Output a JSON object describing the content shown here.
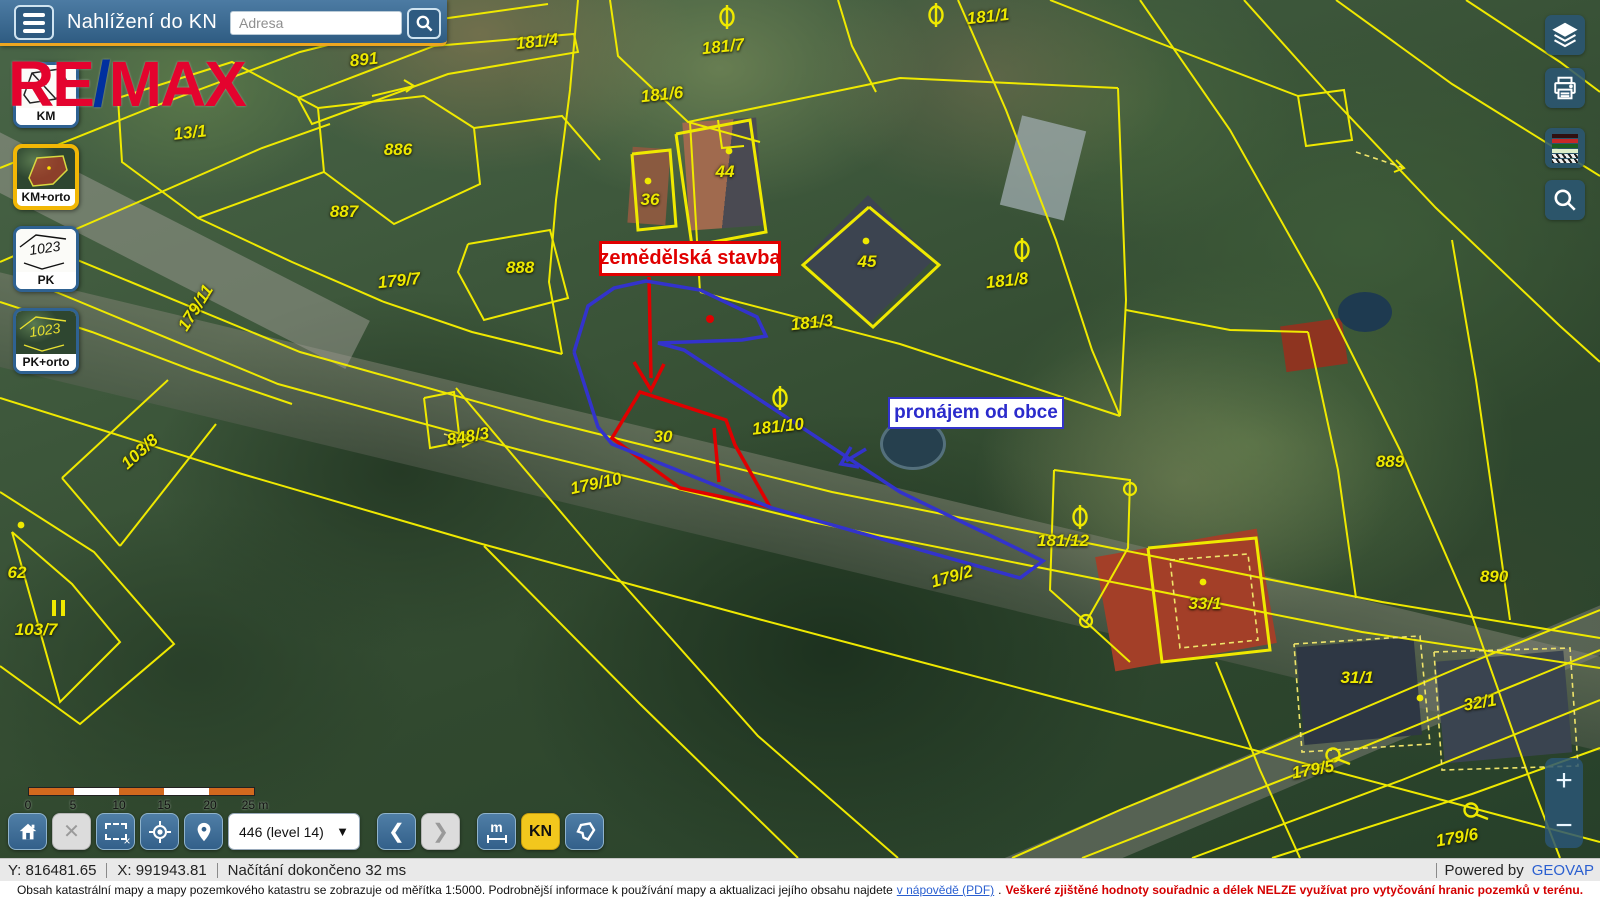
{
  "header": {
    "title": "Nahlížení do KN",
    "address_placeholder": "Adresa"
  },
  "watermark": {
    "part1": "RE",
    "slash": "/",
    "part2": "MAX",
    "color_red": "#e4032e",
    "color_blue": "#00309f"
  },
  "layer_buttons": [
    {
      "id": "km",
      "label": "KM",
      "active": false
    },
    {
      "id": "km-orto",
      "label": "KM+orto",
      "active": true
    },
    {
      "id": "pk",
      "label": "PK",
      "active": false
    },
    {
      "id": "pk-orto",
      "label": "PK+orto",
      "active": false
    }
  ],
  "right_toolbar": {
    "icons": [
      "layers-icon",
      "print-icon",
      "legend-icon",
      "search-icon"
    ]
  },
  "map": {
    "line_color": "#efe900",
    "annotations": {
      "red_label": {
        "text": "zemědělská stavba",
        "color": "#e00000"
      },
      "blue_label": {
        "text": "pronájem od obce",
        "color": "#2b2bcc"
      }
    },
    "parcel_labels": [
      {
        "text": "891",
        "x": 364,
        "y": 60,
        "rot": -6
      },
      {
        "text": "181/4",
        "x": 537,
        "y": 42,
        "rot": -6
      },
      {
        "text": "181/7",
        "x": 723,
        "y": 47,
        "rot": -6
      },
      {
        "text": "181/6",
        "x": 662,
        "y": 95,
        "rot": -6
      },
      {
        "text": "181/1",
        "x": 988,
        "y": 17,
        "rot": -6
      },
      {
        "text": "13/1",
        "x": 190,
        "y": 133,
        "rot": -6
      },
      {
        "text": "886",
        "x": 398,
        "y": 150,
        "rot": 0
      },
      {
        "text": "887",
        "x": 344,
        "y": 212,
        "rot": 0
      },
      {
        "text": "888",
        "x": 520,
        "y": 268,
        "rot": 0
      },
      {
        "text": "179/7",
        "x": 399,
        "y": 281,
        "rot": -6
      },
      {
        "text": "179/11",
        "x": 196,
        "y": 308,
        "rot": -58
      },
      {
        "text": "36",
        "x": 650,
        "y": 200,
        "rot": 0
      },
      {
        "text": "44",
        "x": 725,
        "y": 172,
        "rot": 0
      },
      {
        "text": "45",
        "x": 867,
        "y": 262,
        "rot": 0
      },
      {
        "text": "181/3",
        "x": 812,
        "y": 323,
        "rot": -6
      },
      {
        "text": "181/8",
        "x": 1007,
        "y": 281,
        "rot": -6
      },
      {
        "text": "181/10",
        "x": 778,
        "y": 427,
        "rot": -6
      },
      {
        "text": "30",
        "x": 663,
        "y": 437,
        "rot": 0
      },
      {
        "text": "848/3",
        "x": 468,
        "y": 437,
        "rot": -10
      },
      {
        "text": "179/10",
        "x": 596,
        "y": 484,
        "rot": -12
      },
      {
        "text": "103/8",
        "x": 140,
        "y": 452,
        "rot": -42
      },
      {
        "text": "62",
        "x": 17,
        "y": 573,
        "rot": 0
      },
      {
        "text": "103/7",
        "x": 36,
        "y": 630,
        "rot": 0
      },
      {
        "text": "179/2",
        "x": 952,
        "y": 577,
        "rot": -16
      },
      {
        "text": "181/12",
        "x": 1063,
        "y": 541,
        "rot": 0
      },
      {
        "text": "889",
        "x": 1390,
        "y": 462,
        "rot": 0
      },
      {
        "text": "33/1",
        "x": 1205,
        "y": 604,
        "rot": 0
      },
      {
        "text": "890",
        "x": 1494,
        "y": 577,
        "rot": 0
      },
      {
        "text": "31/1",
        "x": 1357,
        "y": 678,
        "rot": 0
      },
      {
        "text": "32/1",
        "x": 1480,
        "y": 703,
        "rot": -10
      },
      {
        "text": "179/5",
        "x": 1313,
        "y": 770,
        "rot": -10
      },
      {
        "text": "179/6",
        "x": 1457,
        "y": 838,
        "rot": -10
      }
    ],
    "symbols": [
      {
        "type": "theta",
        "x": 727,
        "y": 17
      },
      {
        "type": "theta",
        "x": 936,
        "y": 15
      },
      {
        "type": "theta",
        "x": 1022,
        "y": 250
      },
      {
        "type": "theta",
        "x": 780,
        "y": 398
      },
      {
        "type": "theta",
        "x": 1080,
        "y": 517
      },
      {
        "type": "vertex",
        "x": 1130,
        "y": 489
      },
      {
        "type": "vertex",
        "x": 1086,
        "y": 621
      },
      {
        "type": "circle-tail",
        "x": 1333,
        "y": 755
      },
      {
        "type": "circle-tail",
        "x": 1471,
        "y": 810
      },
      {
        "type": "dot",
        "x": 648,
        "y": 181
      },
      {
        "type": "dot",
        "x": 729,
        "y": 151
      },
      {
        "type": "dot",
        "x": 866,
        "y": 241
      },
      {
        "type": "dot",
        "x": 21,
        "y": 525
      },
      {
        "type": "dot",
        "x": 1203,
        "y": 582
      },
      {
        "type": "dot",
        "x": 1420,
        "y": 698
      }
    ]
  },
  "scalebar": {
    "labels": [
      "0",
      "5",
      "10",
      "15",
      "20",
      "25 m"
    ],
    "positions": [
      0,
      45,
      91,
      136,
      182,
      227
    ]
  },
  "bottom_toolbar": {
    "zoom_select": "446 (level 14)",
    "measure_label": "m",
    "kn_label": "KN"
  },
  "statusbar": {
    "y": "Y: 816481.65",
    "x": "X: 991943.81",
    "status": "Načítání dokončeno 32 ms",
    "powered_prefix": "Powered by",
    "powered_brand": "GEOVAP"
  },
  "disclaimer": {
    "text": "Obsah katastrální mapy a mapy pozemkového katastru se zobrazuje od měřítka 1:5000. Podrobnější informace k používání mapy a aktualizaci jejího obsahu najdete",
    "link": "v nápovědě (PDF)",
    "after_link": ".",
    "warning": "Veškeré zjištěné hodnoty souřadnic a délek NELZE využívat pro vytyčování hranic pozemků v terénu."
  },
  "zoom_control": {
    "plus": "+",
    "minus": "−"
  }
}
